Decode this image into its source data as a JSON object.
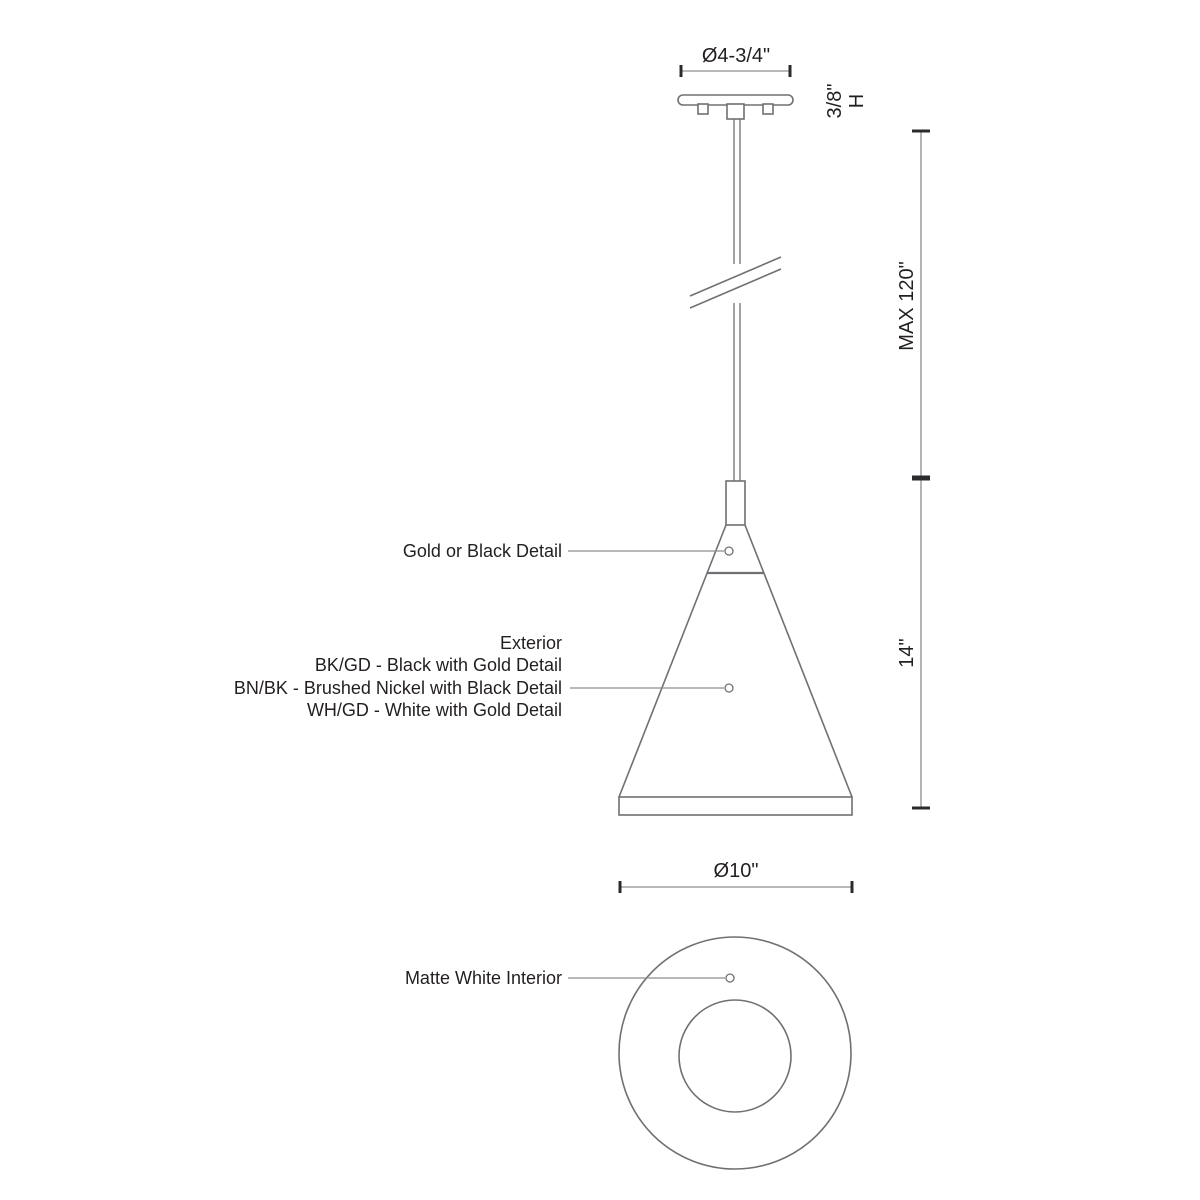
{
  "labels": {
    "canopy_diameter": "Ø4-3/4\"",
    "canopy_height_value": "3/8\"",
    "canopy_height_unit": "H",
    "max_height": "MAX 120\"",
    "shade_height": "14\"",
    "detail": "Gold or Black Detail",
    "exterior_title": "Exterior",
    "exterior_options": [
      "BK/GD - Black with Gold Detail",
      "BN/BK - Brushed Nickel with Black Detail",
      "WH/GD - White with Gold Detail"
    ],
    "shade_diameter": "Ø10\"",
    "interior": "Matte White Interior"
  },
  "colors": {
    "line": "#6f7073",
    "dimension_line": "#8c8d90",
    "tick": "#2b2b2d",
    "text": "#231f20",
    "background": "#ffffff"
  }
}
